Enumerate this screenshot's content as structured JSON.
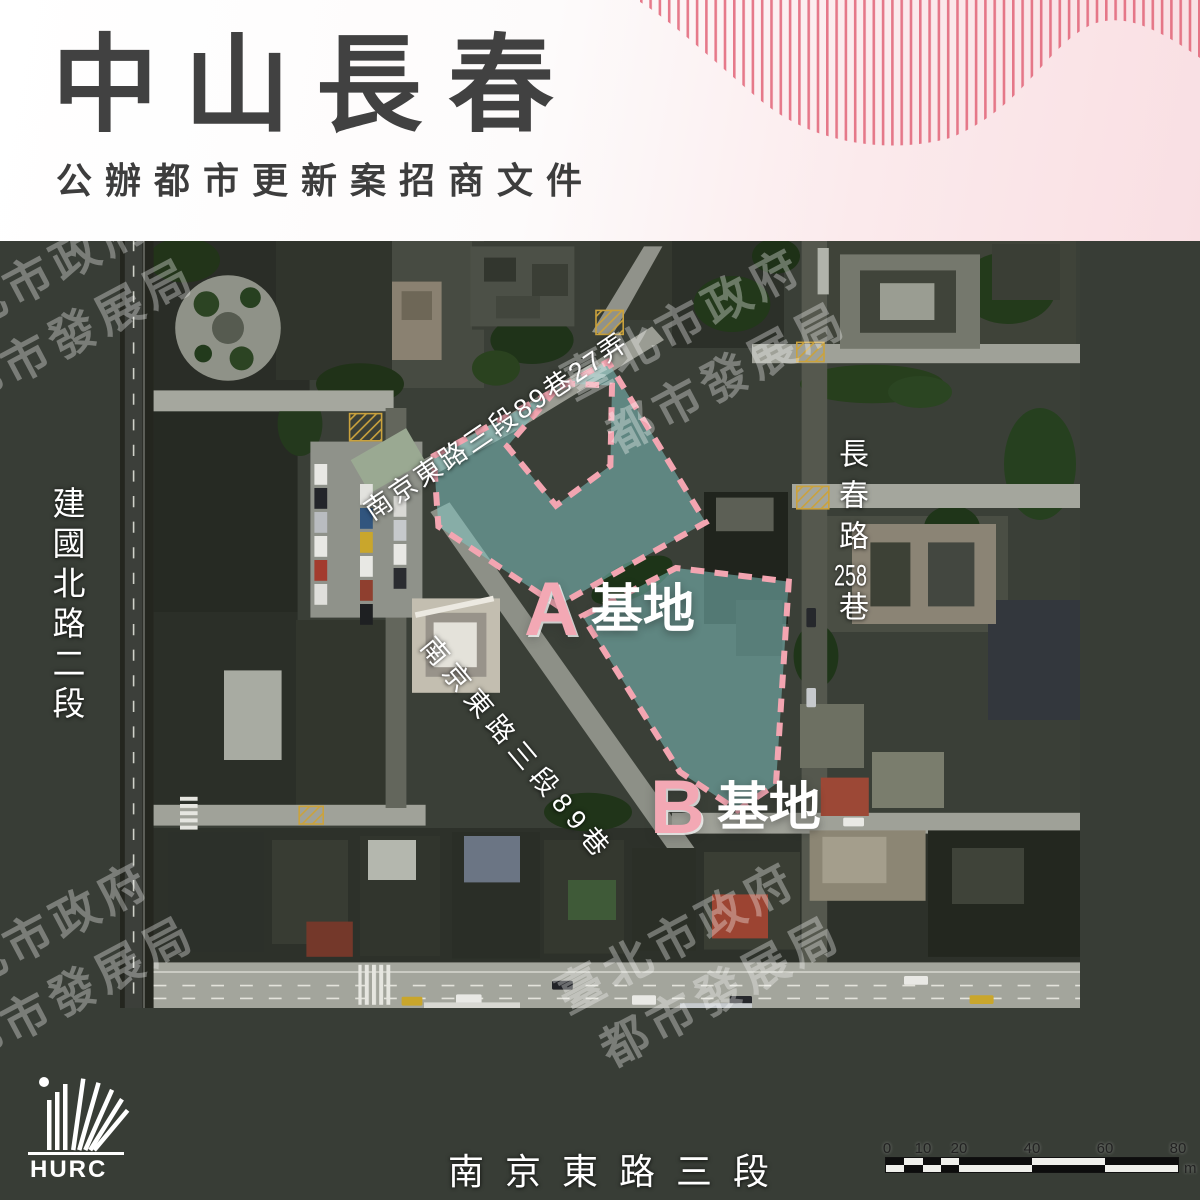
{
  "header": {
    "title": "中山長春",
    "subtitle": "公辦都市更新案招商文件"
  },
  "map": {
    "labels": {
      "road_left": "建國北路二段",
      "lane_top_diagonal": "南京東路三段89巷27弄",
      "lane_mid_diagonal": "南京東路三段89巷",
      "lane_right_part1": "長春路",
      "lane_right_num": "258",
      "lane_right_part2": "巷",
      "road_bottom": "南京東路三段"
    },
    "sites": {
      "a_letter": "A",
      "a_suffix": "基地",
      "b_letter": "B",
      "b_suffix": "基地"
    },
    "watermark": {
      "line1": "臺北市政府",
      "line2": "都市發展局"
    },
    "scalebar": {
      "tick0": "0",
      "tick1": "10",
      "tick2": "20",
      "tick3": "40",
      "tick4": "60",
      "tick5": "80",
      "unit": "m"
    },
    "logo_text": "HURC"
  },
  "colors": {
    "site_boundary_pink": "#f3a5b1",
    "site_fill_teal": "#82c7c6",
    "decor_line_pink": "#e05b70",
    "header_pink": "#f9dfe3",
    "title_gray": "#414141"
  }
}
